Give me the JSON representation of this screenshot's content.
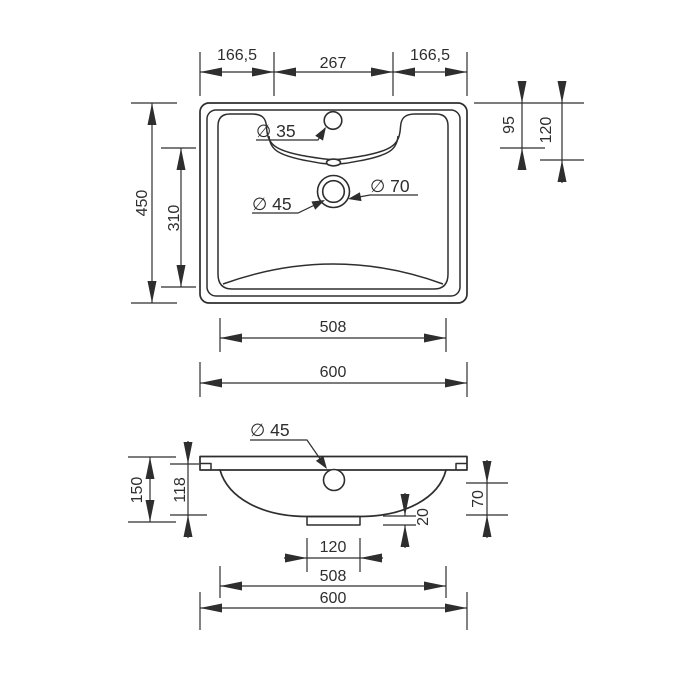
{
  "colors": {
    "line": "#2e2e2e",
    "background": "#ffffff"
  },
  "top_view": {
    "dims": {
      "seg_left": "166,5",
      "seg_center": "267",
      "seg_right": "166,5",
      "height": "450",
      "basin_depth": "310",
      "offset_95": "95",
      "offset_120": "120",
      "faucet_dia": "∅ 35",
      "drain_inner_dia": "∅ 45",
      "drain_outer_dia": "∅ 70",
      "basin_width": "508",
      "width": "600"
    }
  },
  "front_view": {
    "dims": {
      "drain_dia": "∅ 45",
      "height": "150",
      "bowl_depth": "118",
      "offset_70": "70",
      "lip_height": "20",
      "drain_width": "120",
      "basin_width": "508",
      "width": "600"
    }
  }
}
